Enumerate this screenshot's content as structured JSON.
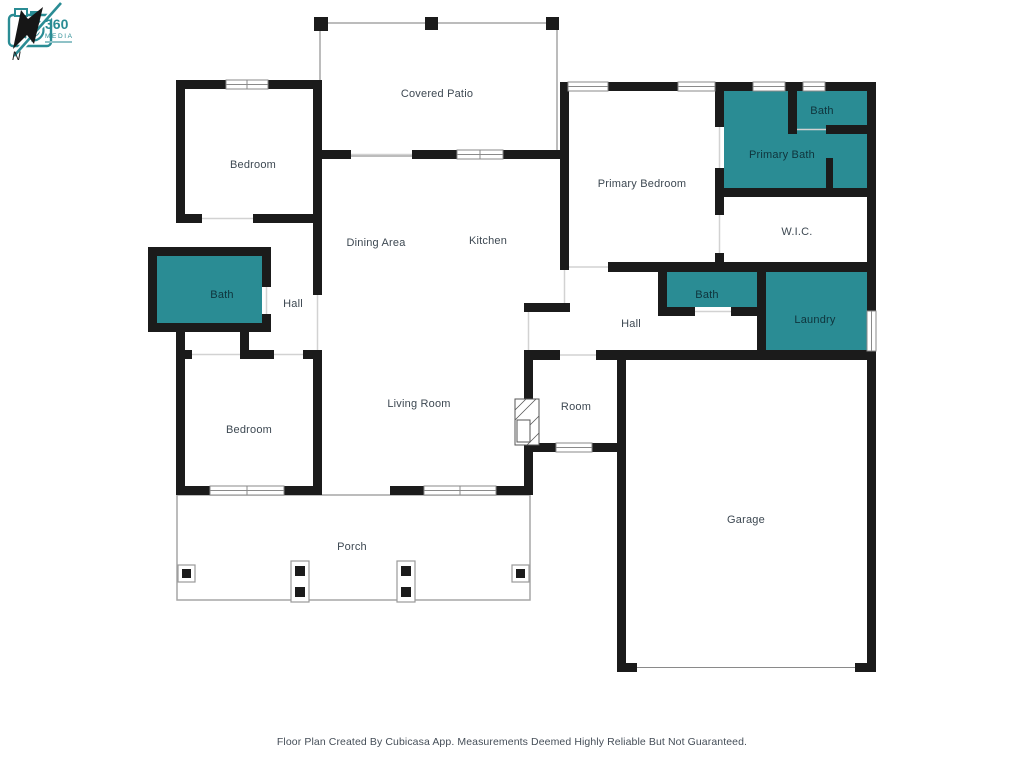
{
  "title": "Floor Plan",
  "colors": {
    "wall": "#1b1b1b",
    "room_fill_teal": "#2a8c94",
    "label": "#3d4852",
    "label_on_teal": "#0f343c",
    "outline_gray": "#a6a6a6"
  },
  "rooms": [
    {
      "id": "covered-patio",
      "label": "Covered Patio",
      "x": 437,
      "y": 94,
      "teal": false
    },
    {
      "id": "bedroom-top-left",
      "label": "Bedroom",
      "x": 253,
      "y": 165,
      "teal": false
    },
    {
      "id": "dining-area",
      "label": "Dining Area",
      "x": 376,
      "y": 243,
      "teal": false
    },
    {
      "id": "kitchen",
      "label": "Kitchen",
      "x": 488,
      "y": 241,
      "teal": false
    },
    {
      "id": "bath-left",
      "label": "Bath",
      "x": 222,
      "y": 295,
      "teal": true
    },
    {
      "id": "hall-left",
      "label": "Hall",
      "x": 293,
      "y": 304,
      "teal": false
    },
    {
      "id": "bedroom-bottom-left",
      "label": "Bedroom",
      "x": 249,
      "y": 430,
      "teal": false
    },
    {
      "id": "living-room",
      "label": "Living Room",
      "x": 419,
      "y": 404,
      "teal": false
    },
    {
      "id": "primary-bedroom",
      "label": "Primary Bedroom",
      "x": 642,
      "y": 184,
      "teal": false
    },
    {
      "id": "bath-top-right",
      "label": "Bath",
      "x": 822,
      "y": 111,
      "teal": true
    },
    {
      "id": "primary-bath",
      "label": "Primary Bath",
      "x": 782,
      "y": 155,
      "teal": true
    },
    {
      "id": "wic",
      "label": "W.I.C.",
      "x": 797,
      "y": 232,
      "teal": false
    },
    {
      "id": "bath-middle",
      "label": "Bath",
      "x": 707,
      "y": 295,
      "teal": true
    },
    {
      "id": "laundry",
      "label": "Laundry",
      "x": 815,
      "y": 320,
      "teal": true
    },
    {
      "id": "hall-right",
      "label": "Hall",
      "x": 631,
      "y": 324,
      "teal": false
    },
    {
      "id": "room",
      "label": "Room",
      "x": 576,
      "y": 407,
      "teal": false
    },
    {
      "id": "garage",
      "label": "Garage",
      "x": 746,
      "y": 520,
      "teal": false
    },
    {
      "id": "porch",
      "label": "Porch",
      "x": 352,
      "y": 547,
      "teal": false
    }
  ],
  "logo": {
    "line1": "360",
    "line2": "MEDIA"
  },
  "compass": {
    "label": "N"
  },
  "footer": {
    "text": "Floor Plan Created By Cubicasa App. Measurements Deemed Highly Reliable But Not Guaranteed."
  }
}
